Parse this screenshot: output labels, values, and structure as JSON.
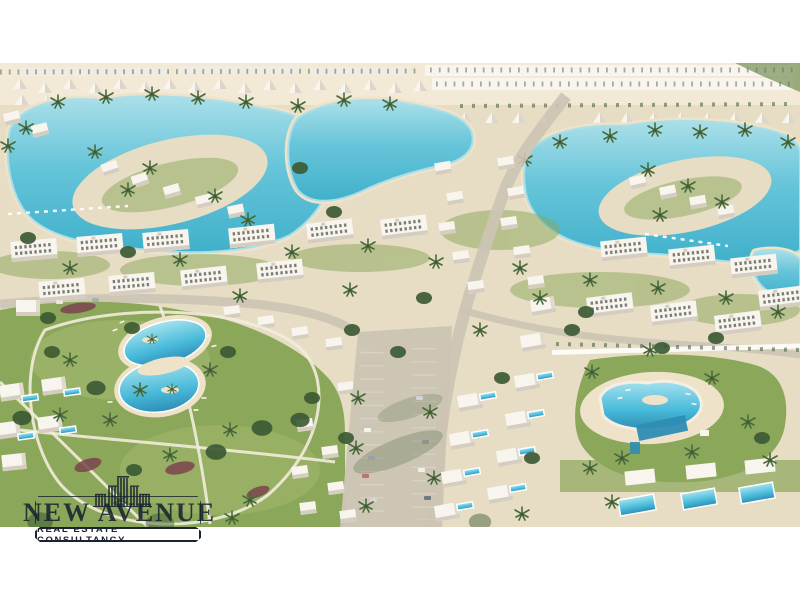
{
  "scene": {
    "description": "Aerial render of a seaside resort community: turquoise lagoons with sandy islands, rows of white A-frame chalets, white apartment blocks, villas with private pools, a landscaped park with a figure-eight lagoon pool, a community pool, palm trees, roads and parking."
  },
  "watermark": {
    "brand": "NEW AVENUE",
    "tagline": "REAL ESTATE CONSULTANCY",
    "icon": "skyline-buildings-icon"
  },
  "colors": {
    "white": "#ffffff",
    "sand": "#e7dcc4",
    "sand-light": "#f2ead6",
    "beach": "#eee3c9",
    "water": "#66c5d9",
    "water-deep": "#41b0cb",
    "water-light": "#aadfe9",
    "grass": "#8aa75a",
    "grass-dark": "#5f7e3e",
    "grass-light": "#a9bd74",
    "tree": "#3d5a35",
    "palm": "#4a6a3c",
    "building": "#f8f5ef",
    "building-shade": "#d5cec0",
    "window": "#474a42",
    "road": "#ccc4b4",
    "path": "#f2ecdc",
    "pool": "#48bada",
    "pool-deep": "#2e8db4",
    "pool-light": "#a5e2ee",
    "flower": "#7b454e",
    "distant": "#efece4",
    "logo": "#1a2330",
    "banner-bg": "#ffffff"
  }
}
